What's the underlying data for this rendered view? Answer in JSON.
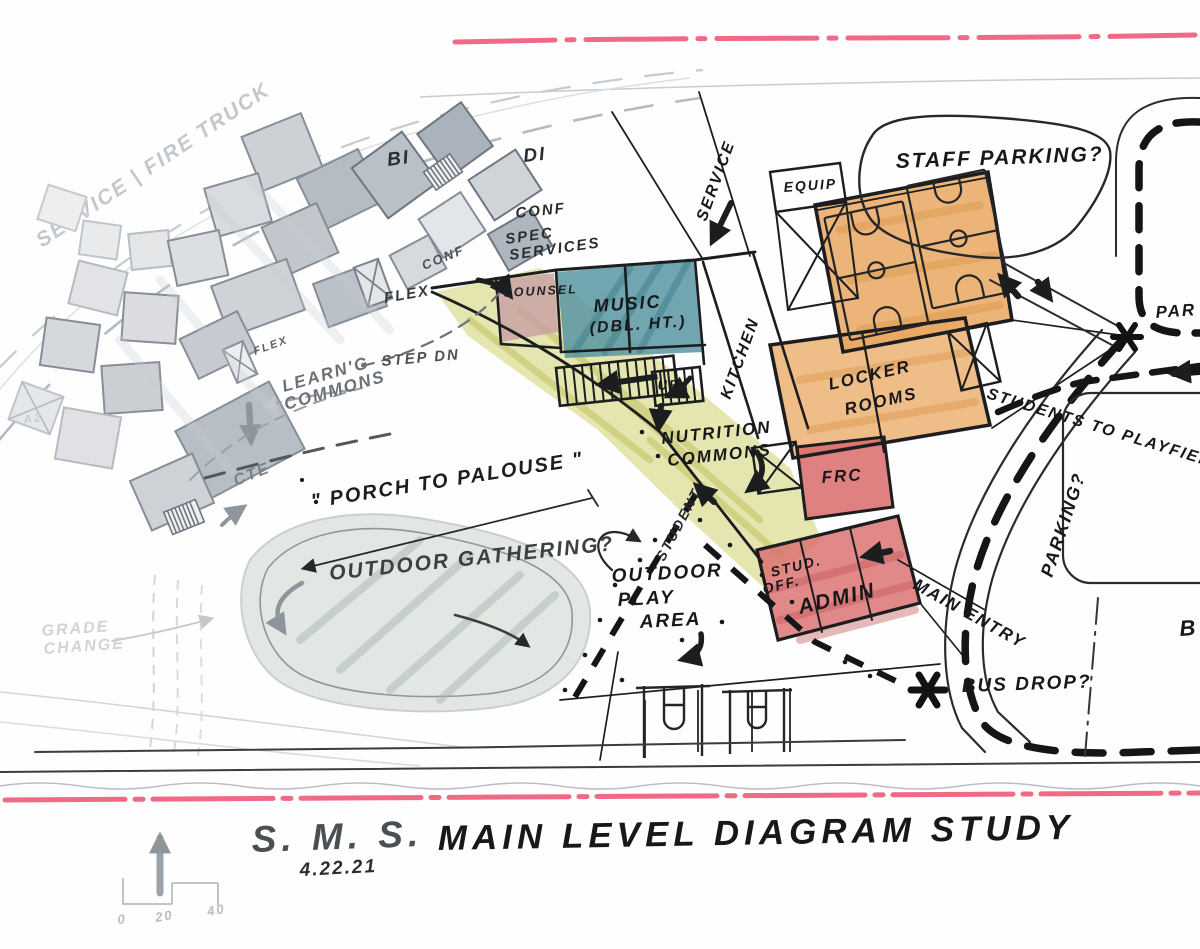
{
  "title_block": {
    "sms": "S. M. S.",
    "main": "MAIN LEVEL DIAGRAM STUDY",
    "date": "4.22.21"
  },
  "scale_bar": {
    "t0": "0",
    "t20": "20",
    "t40": "40"
  },
  "site": {
    "service_fire_truck": "SERVICE | FIRE TRUCK",
    "staff_parking": "STAFF PARKING?",
    "students_to_playfield": "STUDENTS TO PLAYFIELD",
    "parking": "PARKING?",
    "main_entry": "MAIN ENTRY",
    "bus_drop": "BUS DROP?",
    "par_partial": "PAR",
    "b_partial": "B",
    "porch": "\" PORCH TO PALOUSE \"",
    "outdoor_gathering": "OUTDOOR GATHERING?",
    "outdoor_play_1": "OUTDOOR",
    "outdoor_play_2": "PLAY",
    "outdoor_play_3": "AREA",
    "grade_1": "GRADE",
    "grade_2": "CHANGE",
    "student": "STUDENT",
    "service": "SERVICE"
  },
  "rooms": {
    "bi": "BI",
    "di": "DI",
    "conf_a": "CONF",
    "conf_b": "CONF",
    "spec_1": "SPEC",
    "spec_2": "SERVICES",
    "flex_a": "FLEX",
    "flex_b": "FLEX",
    "learng_1": "LEARN'G",
    "learng_2": "COMMONS",
    "cte": "CTE",
    "a2": "A2",
    "counsel": "COUNSEL",
    "music_1": "MUSIC",
    "music_2": "(DBL. HT.)",
    "step_dn": "STEP DN",
    "up": "UP",
    "kitchen": "KITCHEN",
    "equip": "EQUIP",
    "locker_1": "LOCKER",
    "locker_2": "ROOMS",
    "frc": "FRC",
    "stud_1": "STUD.",
    "stud_2": "OFF.",
    "admin": "ADMIN",
    "nutrition_1": "NUTRITION",
    "nutrition_2": "COMMONS"
  },
  "colors": {
    "property_line": "#ee5a78",
    "ink": "#1c1d1f",
    "pencil": "#9aa1a8",
    "gym_orange": "#e9a760",
    "admin_red": "#d96b6b",
    "music_teal": "#5895a2",
    "commons_yellow": "#cfd06e",
    "counsel_pink": "#c79fa3",
    "gathering_green": "#b9c6bf"
  }
}
